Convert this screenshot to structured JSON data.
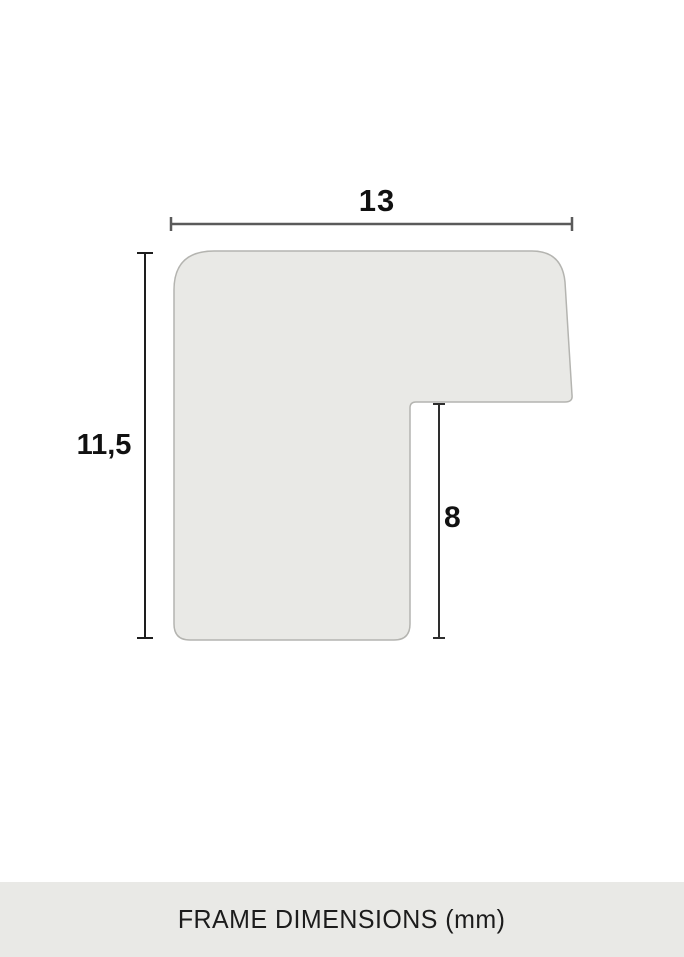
{
  "diagram": {
    "type": "frame-moulding-profile-cross-section",
    "width_label": "13",
    "height_label": "11,5",
    "depth_label": "8",
    "footer_label": "FRAME DIMENSIONS (mm)"
  },
  "colors": {
    "background": "#ffffff",
    "profile_fill": "#e9e9e6",
    "profile_stroke": "#b4b4b0",
    "width_dimension_line": "#5a5a5a",
    "height_dimension_line": "#1e1e1e",
    "depth_dimension_line": "#2e2e2e",
    "label_text": "#111111",
    "footer_bg": "#e9e9e6",
    "footer_text": "#1c1c1c"
  }
}
